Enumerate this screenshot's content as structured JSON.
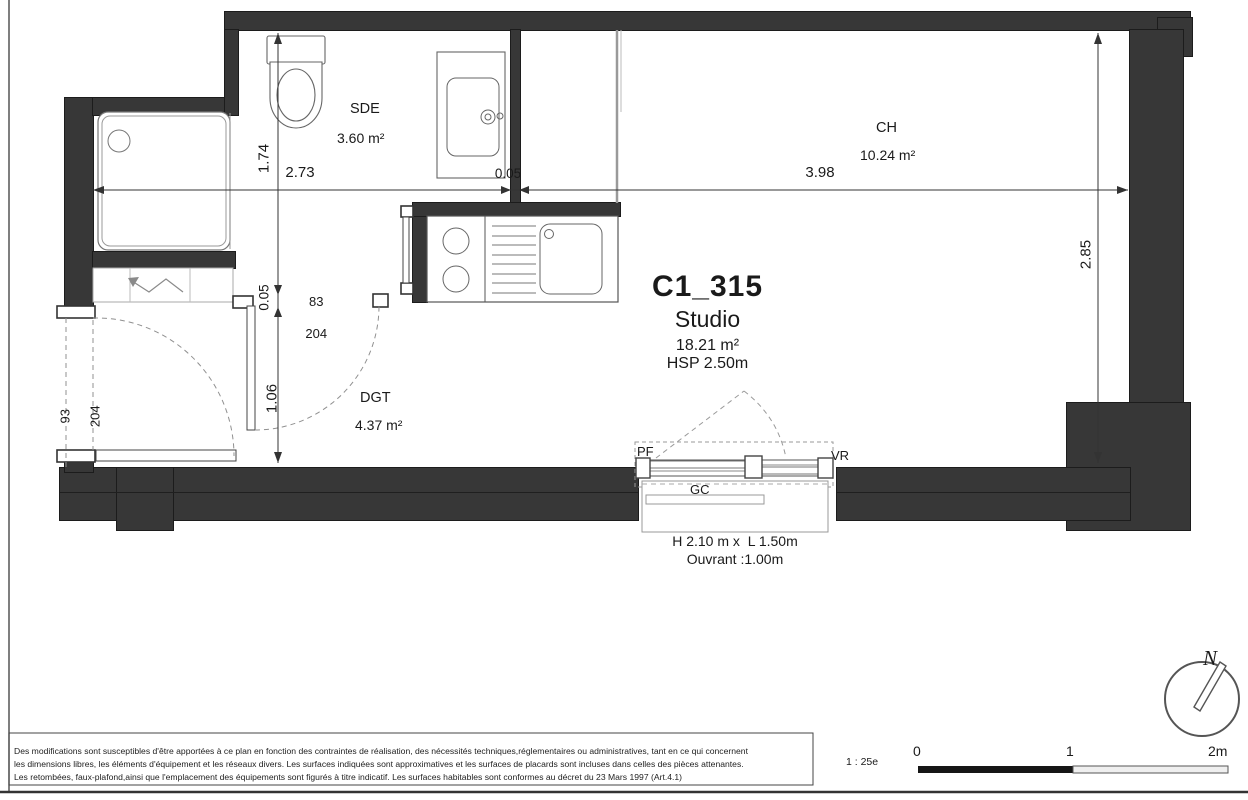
{
  "title_block": {
    "unit_id": "C1_315",
    "unit_type": "Studio",
    "area": "18.21 m²",
    "ceiling_height": "HSP 2.50m"
  },
  "rooms": {
    "sde": {
      "name": "SDE",
      "area": "3.60 m²"
    },
    "ch": {
      "name": "CH",
      "area": "10.24 m²"
    },
    "dgt": {
      "name": "DGT",
      "area": "4.37 m²"
    }
  },
  "dimensions": {
    "sde_width": "2.73",
    "partition_thickness": "0.05",
    "ch_width": "3.98",
    "sde_depth": "1.74",
    "wall_thickness": "0.05",
    "entry_width": "1.06",
    "ch_depth": "2.85"
  },
  "doors": {
    "entrance": {
      "width": "93",
      "height": "204"
    },
    "sde": {
      "width": "83",
      "height": "204"
    }
  },
  "window": {
    "pf_label": "PF",
    "vr_label": "VR",
    "gc_label": "GC",
    "size": "H 2.10 m x  L 1.50m",
    "opening": "Ouvrant :1.00m"
  },
  "footer": {
    "disclaimer_line1": "Des modifications sont susceptibles d'être apportées à ce plan en fonction des contraintes de réalisation, des nécessités techniques,réglementaires ou administratives, tant en ce qui concernent",
    "disclaimer_line2": "les dimensions libres, les éléments d'équipement et les réseaux divers. Les surfaces indiquées sont approximatives et les surfaces de placards sont incluses dans celles des pièces attenantes.",
    "disclaimer_line3": "Les retombées, faux-plafond,ainsi que l'emplacement des équipements sont figurés à titre indicatif. Les surfaces habitables sont conformes au décret du 23 Mars 1997 (Art.4.1)",
    "scale_label": "1 : 25e",
    "scale_ticks": [
      "0",
      "1",
      "2m"
    ]
  },
  "compass": {
    "north_label": "N"
  },
  "colors": {
    "wall": "#373737",
    "line": "#2a2a2a",
    "fixture": "#666666",
    "dashed": "#909090"
  }
}
